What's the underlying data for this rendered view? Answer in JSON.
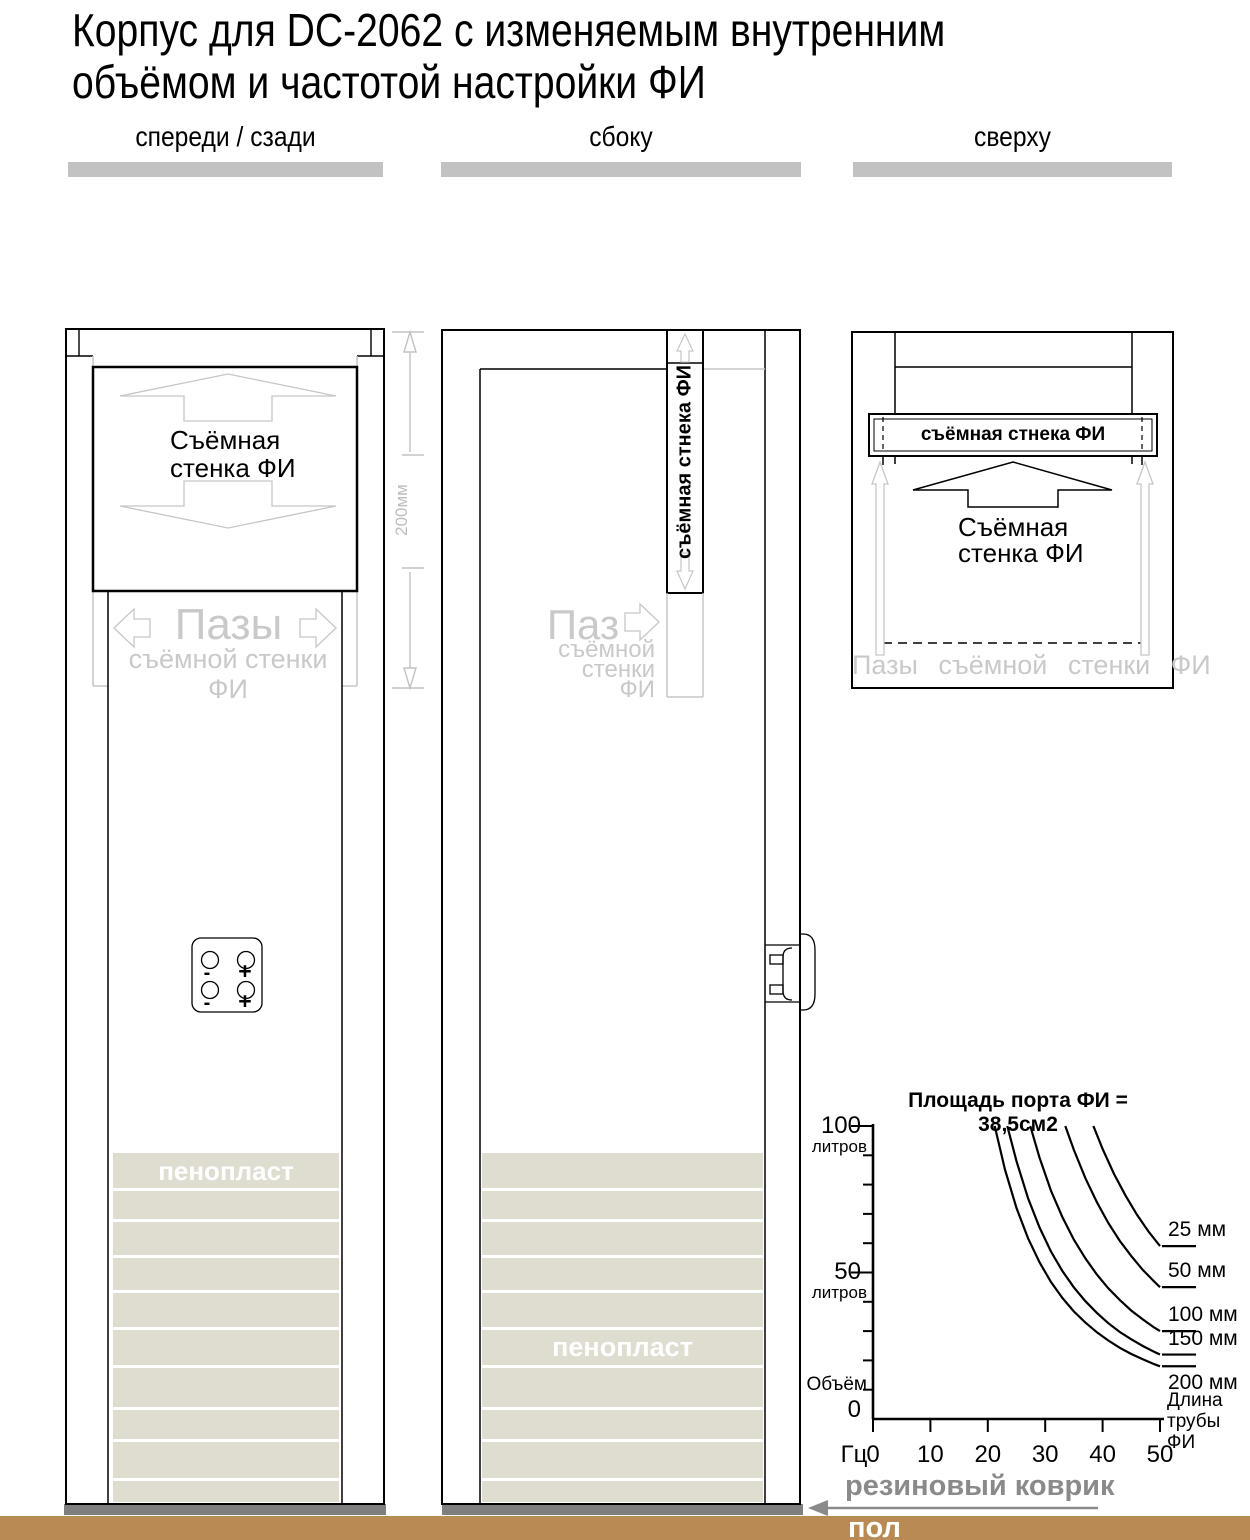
{
  "header": {
    "title_line1": "Корпус для DC-2062 с изменяемым внутренним",
    "title_line2": "объёмом и частотой настройки ФИ"
  },
  "views": {
    "front": {
      "label": "спереди / сзади",
      "panel_label": "Съёмная\nстенка ФИ",
      "grooves_title": "Пазы",
      "grooves_sub": "съёмной стенки",
      "grooves_sub2": "ФИ",
      "dimension_label": "200мм",
      "foam_label": "пенопласт",
      "terminal_signs": [
        "-",
        "+",
        "-",
        "+"
      ]
    },
    "side": {
      "label": "сбоку",
      "strip_label": "съёмная стнека ФИ",
      "groove_title": "Паз",
      "groove_sub": "съёмной\nстенки\nФИ",
      "foam_label": "пенопласт"
    },
    "top": {
      "label": "сверху",
      "bar_label": "съёмная стнека ФИ",
      "panel_label": "Съёмная\nстенка ФИ",
      "grooves_label": "Пазы съёмной стенки ФИ"
    }
  },
  "floor": {
    "mat_label": "резиновый коврик",
    "floor_label": "пол"
  },
  "colors": {
    "foam": "#deddd0",
    "mat": "#7f7f7f",
    "floor": "#ba8a54",
    "light_line": "#c6c6c6",
    "light_text": "#c9c9c9"
  },
  "chart_data": {
    "type": "line",
    "title": "Площадь порта ФИ = 38,5см2",
    "xlabel": "Гц",
    "legend_title": "Длина\nтрубы ФИ",
    "grid": false,
    "xlim": [
      0,
      50
    ],
    "ylim": [
      0,
      100
    ],
    "x_ticks": [
      0,
      10,
      20,
      30,
      40,
      50
    ],
    "y_axis": {
      "top_value": "100",
      "top_unit": "литров",
      "mid_value": "50",
      "mid_unit": "литров",
      "origin_label": "Объём",
      "zero_value": "0"
    },
    "series": [
      {
        "name": "25 мм",
        "points": [
          [
            38.4,
            100
          ],
          [
            40,
            92.2
          ],
          [
            42,
            83.6
          ],
          [
            44,
            76.2
          ],
          [
            46,
            69.7
          ],
          [
            48,
            64.0
          ],
          [
            50,
            59.0
          ]
        ]
      },
      {
        "name": "50 мм",
        "points": [
          [
            33.5,
            100
          ],
          [
            35,
            91.8
          ],
          [
            37,
            82.2
          ],
          [
            39,
            74.0
          ],
          [
            41,
            66.9
          ],
          [
            43,
            60.8
          ],
          [
            45,
            55.6
          ],
          [
            47,
            50.9
          ],
          [
            49,
            46.9
          ],
          [
            50,
            45.0
          ]
        ]
      },
      {
        "name": "100 мм",
        "points": [
          [
            27.4,
            100
          ],
          [
            29,
            89.2
          ],
          [
            31,
            78.0
          ],
          [
            33,
            68.9
          ],
          [
            35,
            61.2
          ],
          [
            37,
            54.8
          ],
          [
            39,
            49.3
          ],
          [
            41,
            44.6
          ],
          [
            43,
            40.6
          ],
          [
            45,
            37.0
          ],
          [
            47,
            34.0
          ],
          [
            49,
            31.2
          ],
          [
            50,
            30.0
          ]
        ]
      },
      {
        "name": "150 мм",
        "points": [
          [
            23.4,
            100
          ],
          [
            25,
            88.0
          ],
          [
            27,
            75.4
          ],
          [
            29,
            65.4
          ],
          [
            31,
            57.2
          ],
          [
            33,
            50.5
          ],
          [
            35,
            44.9
          ],
          [
            37,
            40.2
          ],
          [
            39,
            36.2
          ],
          [
            41,
            32.7
          ],
          [
            43,
            29.7
          ],
          [
            45,
            27.2
          ],
          [
            47,
            24.9
          ],
          [
            49,
            22.9
          ],
          [
            50,
            22.0
          ]
        ]
      },
      {
        "name": "200 мм",
        "points": [
          [
            21.2,
            100
          ],
          [
            23,
            85.1
          ],
          [
            25,
            72.0
          ],
          [
            27,
            61.7
          ],
          [
            29,
            53.5
          ],
          [
            31,
            46.8
          ],
          [
            33,
            41.3
          ],
          [
            35,
            36.7
          ],
          [
            37,
            32.9
          ],
          [
            39,
            29.6
          ],
          [
            41,
            26.8
          ],
          [
            43,
            24.3
          ],
          [
            45,
            22.2
          ],
          [
            47,
            20.4
          ],
          [
            49,
            18.7
          ],
          [
            50,
            18.0
          ]
        ]
      }
    ]
  }
}
